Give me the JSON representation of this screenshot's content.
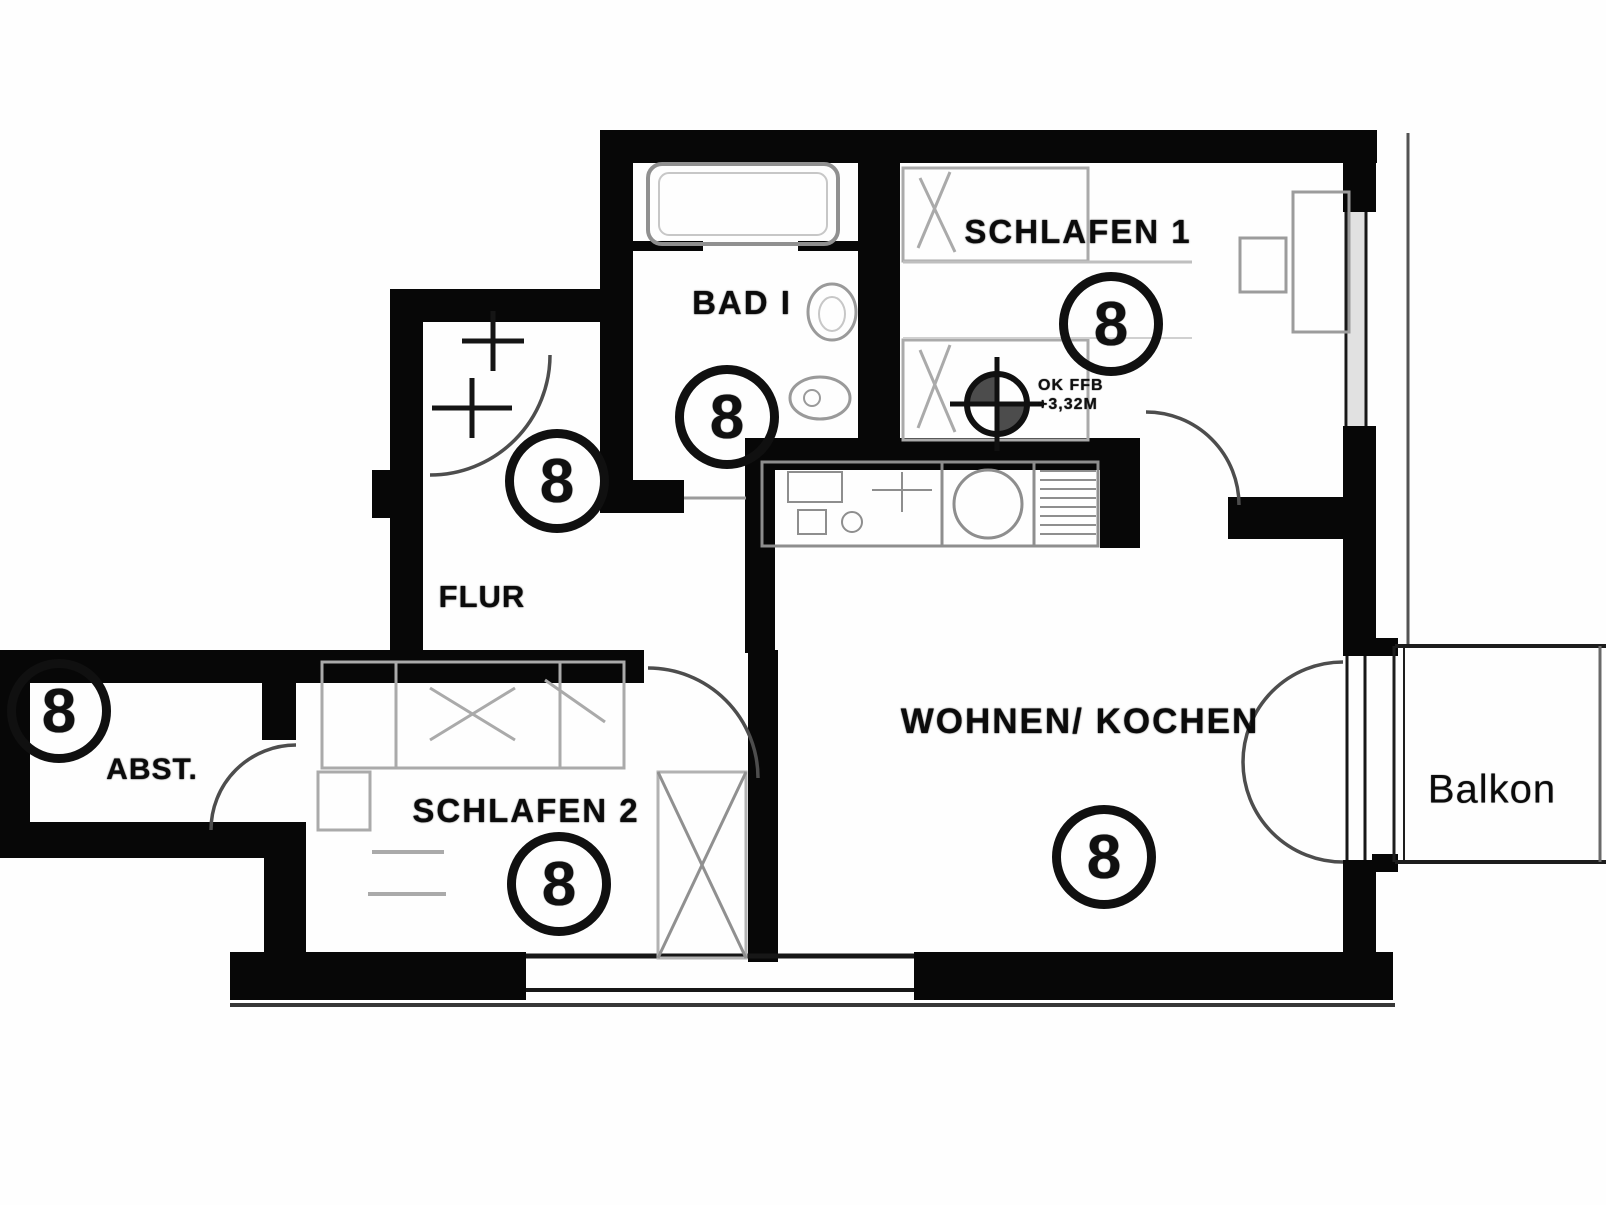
{
  "plan": {
    "rooms": {
      "schlafen1": {
        "label": "SCHLAFEN 1",
        "marker": "8"
      },
      "bad": {
        "label": "BAD I",
        "marker": "8"
      },
      "flur": {
        "label": "FLUR",
        "marker": "8"
      },
      "abst": {
        "label": "ABST.",
        "marker": "8"
      },
      "schlafen2": {
        "label": "SCHLAFEN 2",
        "marker": "8"
      },
      "wohnen_kochen": {
        "label": "WOHNEN/ KOCHEN",
        "marker": "8"
      },
      "balkon": {
        "label": "Balkon"
      }
    },
    "annotations": {
      "height_note_line1": "OK FFB",
      "height_note_line2": "+3,32M"
    },
    "colors": {
      "wall": "#0d0d0d",
      "furniture": "#9e9e9e",
      "background": "#fefefe"
    }
  }
}
